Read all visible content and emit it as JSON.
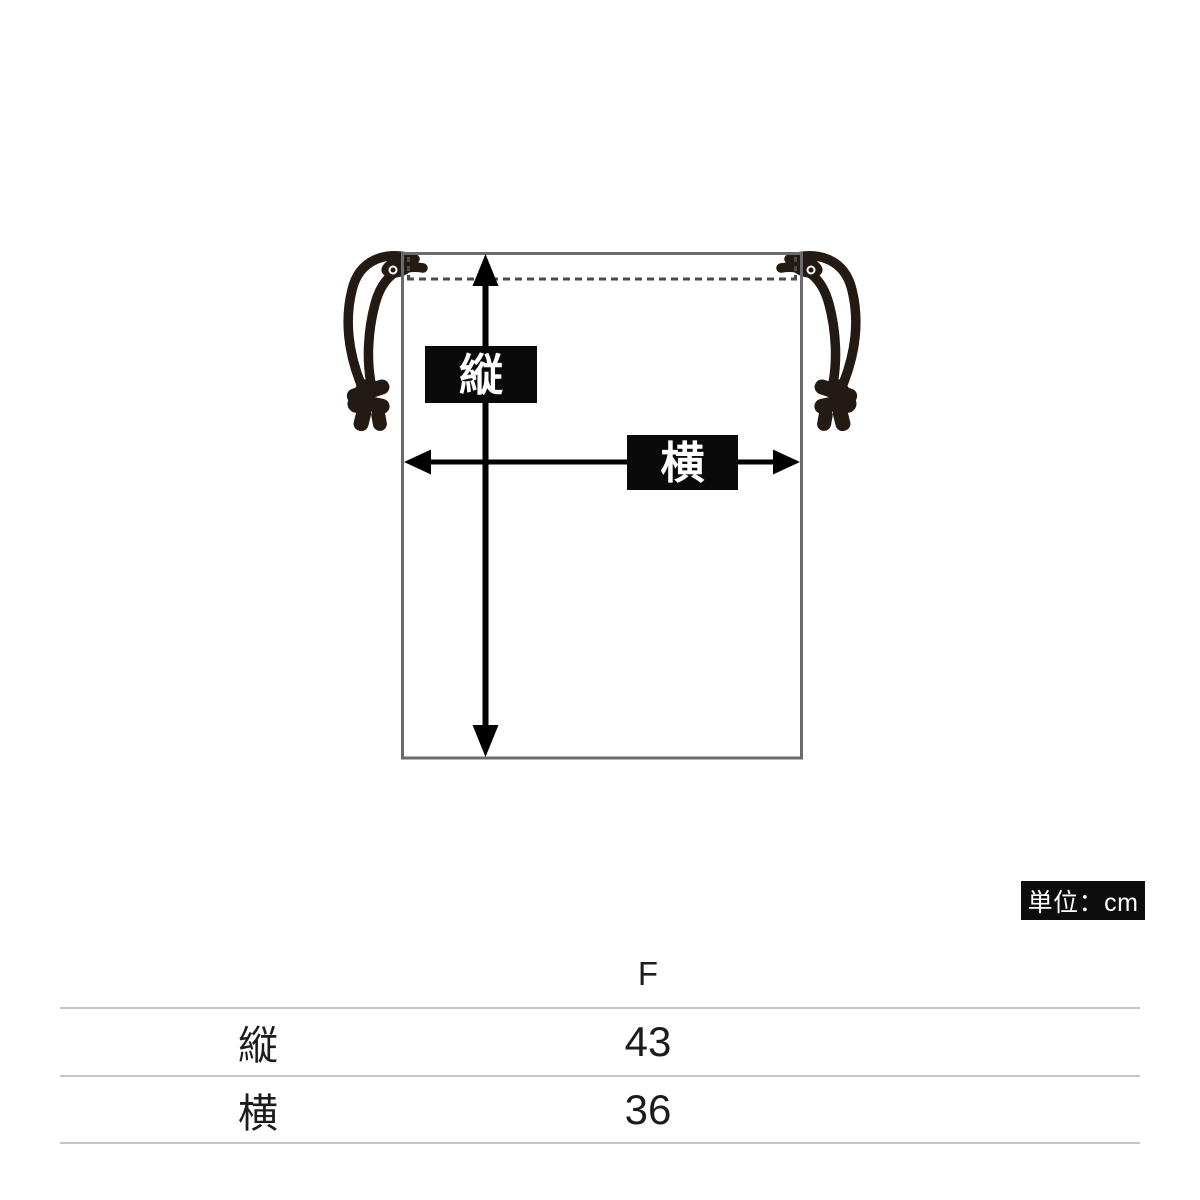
{
  "diagram": {
    "vertical_dim_label": "縦",
    "horizontal_dim_label": "横",
    "colors": {
      "bag_outline": "#6b6b6b",
      "stitch_dash": "#4a4a4a",
      "arrow": "#000000",
      "label_box_bg": "#0a0a0a",
      "label_text": "#ffffff",
      "cord": "#241a14"
    }
  },
  "unit_badge": {
    "text": "単位：cm"
  },
  "size_table": {
    "size_header": "F",
    "rows": [
      {
        "label": "縦",
        "value": "43"
      },
      {
        "label": "横",
        "value": "36"
      }
    ]
  }
}
